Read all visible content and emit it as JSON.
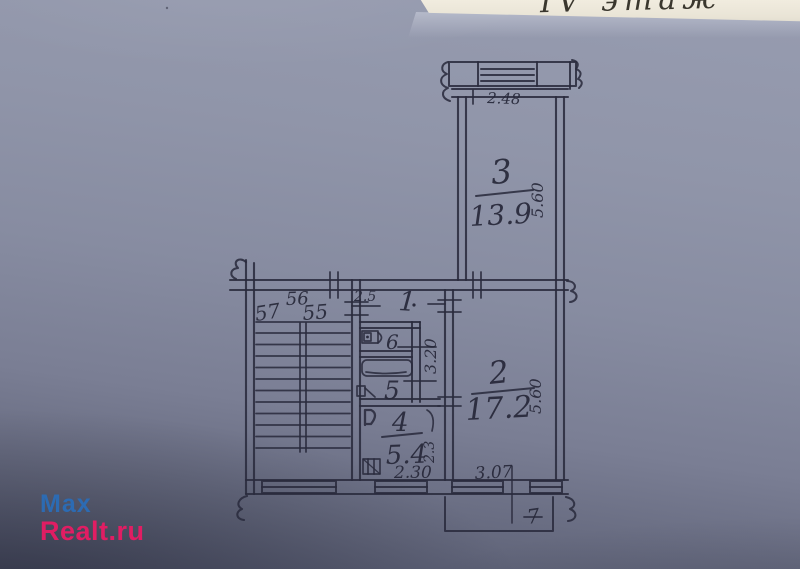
{
  "photo": {
    "floor_label": "IV этаж"
  },
  "watermark": {
    "line1": "Max",
    "line2": "Realt.ru",
    "color_line1": "#2c6bb3",
    "color_line2": "#e11d63"
  },
  "plan": {
    "balcony_top": {
      "width": "2.48"
    },
    "balcony_bottom": {
      "mark": "7"
    },
    "room1": {
      "number": "1",
      "width": "2.5"
    },
    "room2": {
      "number": "2",
      "area": "17.2",
      "depth": "5.60",
      "width": "3.07"
    },
    "room3": {
      "number": "3",
      "area": "13.9",
      "depth": "5.60"
    },
    "room4": {
      "number": "4",
      "area": "5.4",
      "width": "2.30",
      "side": "2.3"
    },
    "room5": {
      "number": "5"
    },
    "room6": {
      "number": "6"
    },
    "bath_block": {
      "depth": "3.20"
    },
    "apartments": {
      "left": "57",
      "center": "55",
      "top": "56"
    }
  }
}
